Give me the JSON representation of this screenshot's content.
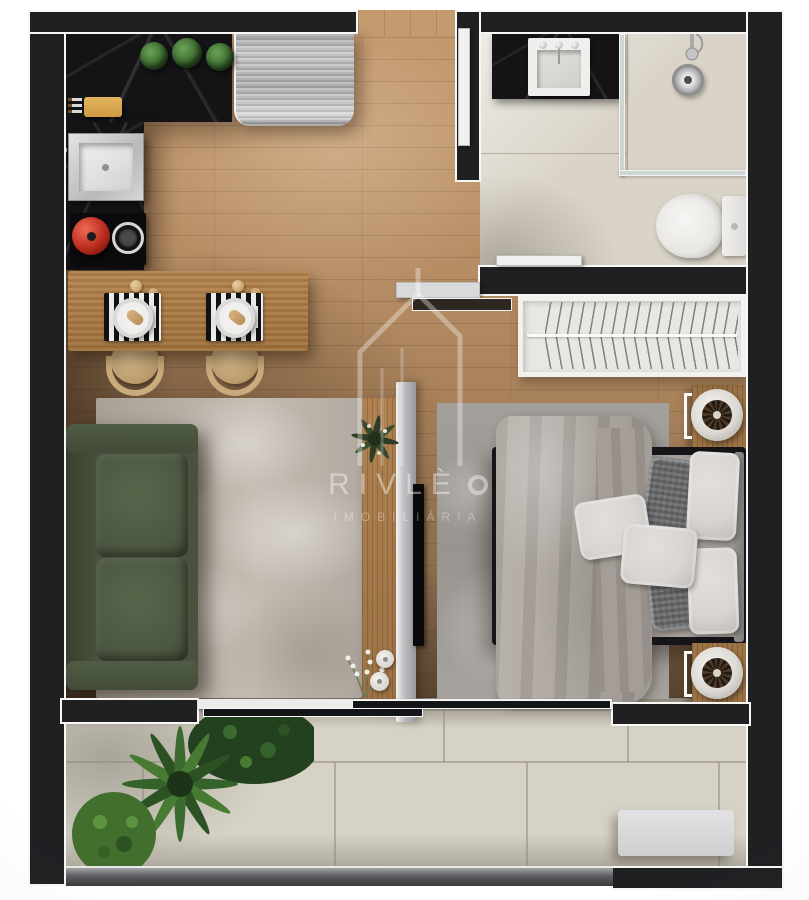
{
  "watermark": {
    "brand": "RIVLÈ",
    "tagline": "IMOBILIÁRIA",
    "logo": "house-outline-icon"
  },
  "palette": {
    "wall": "#202023",
    "floor-wood": "#b48c63",
    "floor-wood-dark": "#6e5943",
    "marble-black": "#141417",
    "steel-gray": "#b6b6b8",
    "bath-floor": "#dad4c8",
    "balcony-tile": "#d7d2c6",
    "rug-living": "#b6aea5",
    "rug-bedroom": "#9e9a96",
    "sofa-green": "#49523f",
    "wood-furniture": "#a87c4e",
    "duvet-gray": "#aaa39d",
    "pillow-white": "#d7d4d1",
    "pillow-dark": "#6e6f71",
    "pot-red": "#b92a1e",
    "plant-green": "#3c6b2f",
    "closet-white": "#e9e7e3",
    "panel-gray": "#bbbcbe",
    "glass-teal": "#cdd6d2"
  }
}
